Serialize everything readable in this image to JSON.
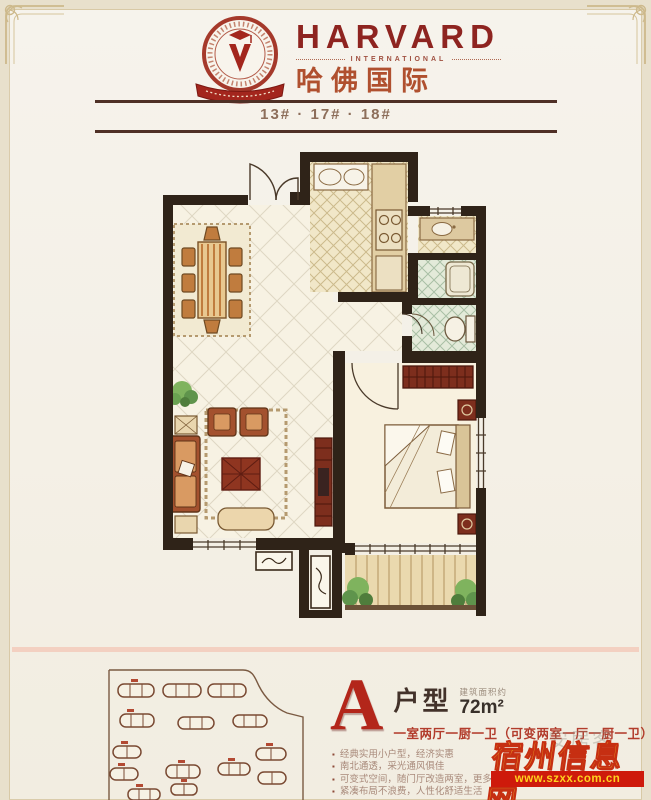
{
  "brand": {
    "name": "HARVARD",
    "tagline": "INTERNATIONAL",
    "cn_name": "哈佛国际"
  },
  "buildings_line": "13# · 17# · 18#",
  "unit": {
    "letter": "A",
    "type_label": "户型",
    "area_note": "建筑面积约",
    "area_value": "72m²",
    "layout": "一室两厅一厨一卫（可变两室一厅一厨一卫）",
    "features": [
      "经典实用小户型，经济实惠",
      "南北通透，采光通风俱佳",
      "可变式空间，随门厅改造两室，更多生活可能",
      "紧凑布局不浪费，人性化舒适生活"
    ]
  },
  "watermark": {
    "portal": "安居客",
    "site_name": "宿州信息网",
    "site_url": "www.szxx.com.cn"
  },
  "colors": {
    "brand_red": "#8e2420",
    "wall": "#2f2318",
    "accent_red": "#b3261a",
    "watermark_gold": "#f3b92b"
  }
}
